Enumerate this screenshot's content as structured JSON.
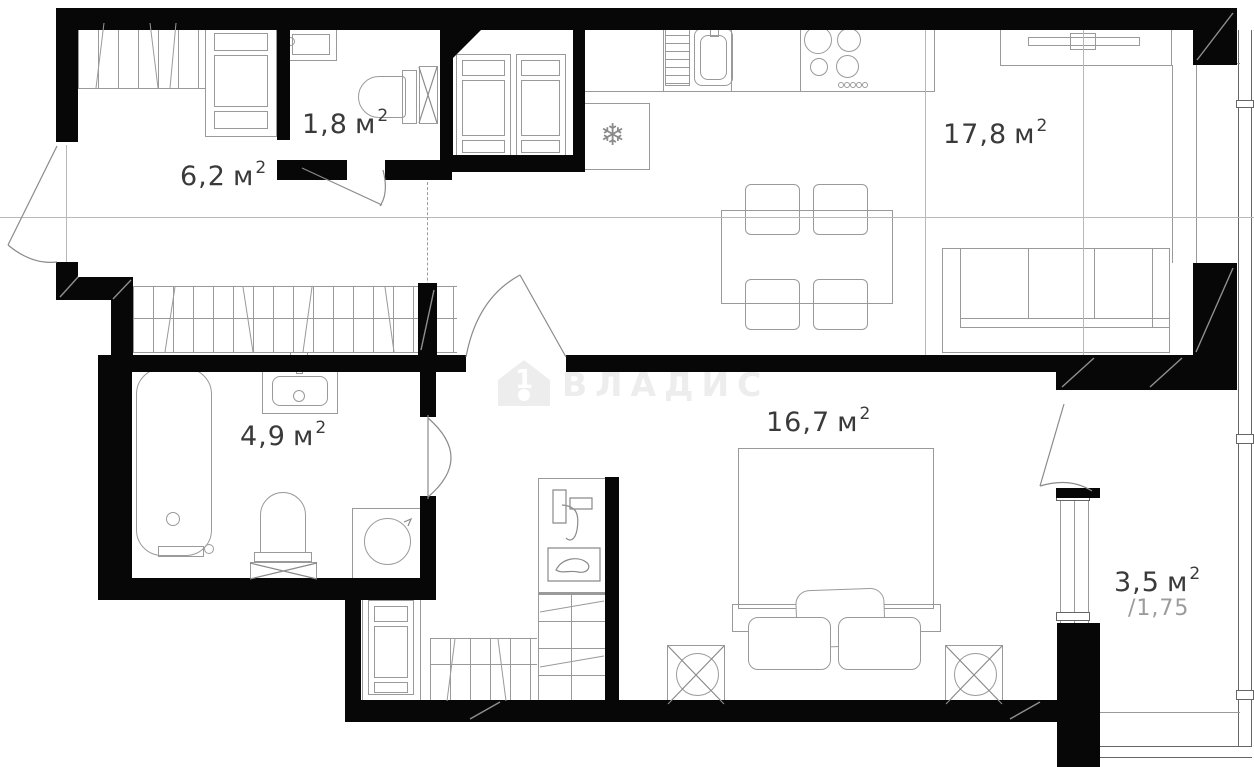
{
  "watermark": {
    "brand": "ВЛАДИС",
    "digit": "1"
  },
  "rooms": {
    "hall": {
      "area": "6,2",
      "unit": "м",
      "sup": "2"
    },
    "wc": {
      "area": "1,8",
      "unit": "м",
      "sup": "2"
    },
    "kitchen_living": {
      "area": "17,8",
      "unit": "м",
      "sup": "2"
    },
    "bathroom": {
      "area": "4,9",
      "unit": "м",
      "sup": "2"
    },
    "bedroom": {
      "area": "16,7",
      "unit": "м",
      "sup": "2"
    },
    "balcony": {
      "area": "3,5",
      "unit": "м",
      "sup": "2",
      "reduced": "/1,75"
    }
  },
  "icons": {
    "snowflake": "❄"
  },
  "colors": {
    "wall": "#070707",
    "furniture_line": "#9a9a9a",
    "axis_line": "#b8b8b8",
    "label": "#3a3a3a",
    "watermark": "#ededed"
  }
}
